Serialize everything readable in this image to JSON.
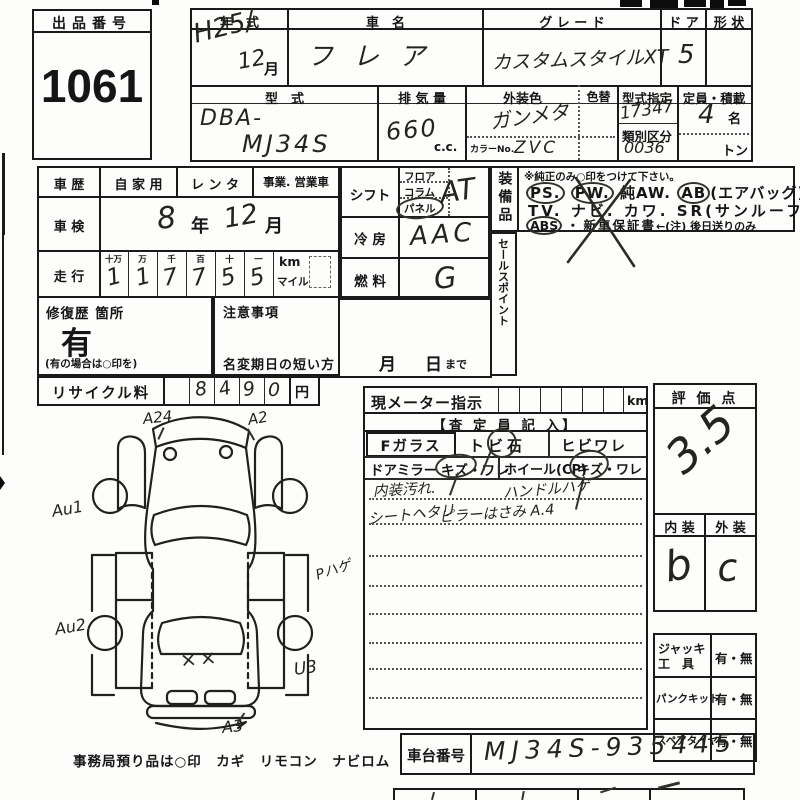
{
  "lot": {
    "label": "出品番号",
    "number": "1061"
  },
  "top": {
    "h_year": "年　式",
    "h_name": "車　名",
    "h_grade": "グ レ ー ド",
    "h_door": "ド ア",
    "h_shape": "形 状",
    "year": "H25/",
    "year2": "12",
    "year_unit": "月",
    "name": "フレア",
    "grade": "カスタムスタイルXT",
    "door": "5",
    "shape": "",
    "h_model": "型　式",
    "h_disp": "排 気 量",
    "h_color": "外装色",
    "h_colorchg": "色替",
    "h_typedes": "型式指定",
    "h_class": "類別区分",
    "h_cap": "定員・積載",
    "model1": "DBA-",
    "model2": "MJ34S",
    "disp": "660",
    "disp_unit": "c.c.",
    "color": "ガンメタ",
    "color_no_label": "カラーNo.",
    "color_no": "ZVC",
    "typedes": "17347",
    "class_no": "0036",
    "cap": "4",
    "cap_unit": "名",
    "ton": "トン"
  },
  "hist": {
    "label": "車 歴",
    "opt1": "自 家 用",
    "opt2": "レ ン タ",
    "opt3": "事業. 営業車"
  },
  "shaken": {
    "label": "車 検",
    "y": "8",
    "y_unit": "年",
    "m": "12",
    "m_unit": "月"
  },
  "mileage": {
    "label": "走 行",
    "heads": [
      "十万",
      "万",
      "千",
      "百",
      "十",
      "一"
    ],
    "digits": [
      "1",
      "1",
      "7",
      "7",
      "5",
      "5"
    ],
    "km": "km",
    "mile": "マイル"
  },
  "repair": {
    "label": "修復歴 箇所",
    "value": "有",
    "note": "(有の場合は○印を)"
  },
  "caution": {
    "label": "注意事項",
    "line": "名変期日の短い方",
    "month": "月",
    "day": "日",
    "made": "まで"
  },
  "recycle": {
    "label": "リサイクル料",
    "digits": [
      "8",
      "4",
      "9",
      "0"
    ],
    "yen": "円"
  },
  "shift": {
    "label": "シフト",
    "opts": [
      "フロア",
      "コラム",
      "パネル"
    ],
    "value": "AT"
  },
  "cool": {
    "label": "冷 房",
    "value": "AAC"
  },
  "fuel": {
    "label": "燃 料",
    "value": "G"
  },
  "equip": {
    "label": "装備品",
    "note": "※純正のみ○印をつけて下さい。",
    "ps": "PS.",
    "pw": "PW.",
    "aw": "純AW.",
    "ab": "AB",
    "ab2": "(エアバッグ)",
    "tv": "TV.",
    "navi": "ナビ.",
    "kawa": "カワ.",
    "sr": "SR(サンルーフ)",
    "abs": "ABS",
    "sep": "・",
    "warranty": "新車保証書",
    "wnote": "←(注) 後日送りのみ"
  },
  "sales": {
    "label": "セールスポイント"
  },
  "meter": {
    "label": "現メーター指示",
    "unit": "km"
  },
  "assess": {
    "title": "【査 定 員 記 入】",
    "fglass": "Fガラス",
    "tobi": "トビ石",
    "hibi": "ヒビワレ",
    "mirror": "ドアミラー",
    "kw1": "キズ・ワレ",
    "wheel": "ホイール(CP)",
    "kw2": "キズ・ワレ",
    "n1a": "内装汚れ.",
    "n1b": "ハンドルハゲ",
    "n2a": "シートヘタリ",
    "n2b": "ピラーはさみ A.4"
  },
  "score": {
    "label": "評 価 点",
    "value": "3.5",
    "h_int": "内 装",
    "h_ext": "外 装",
    "interior": "b",
    "exterior": "c"
  },
  "tools": {
    "jack1": "ジャッキ",
    "jack2": "工　具",
    "jack_v": "有・無",
    "pank": "パンクキット",
    "pank_v": "有・無",
    "spare": "スペアタイヤ",
    "spare_v": "有・無"
  },
  "chassis": {
    "label": "車台番号",
    "value": "MJ34S-935445"
  },
  "diagram": {
    "a24": "A24",
    "a2": "A2",
    "au1": "Au1",
    "phage": "Pハゲ",
    "au2": "Au2",
    "xx": "××",
    "u3": "U3",
    "a3": "A3",
    "caption": "事務局預り品は○印　カギ　リモコン　ナビロム"
  }
}
